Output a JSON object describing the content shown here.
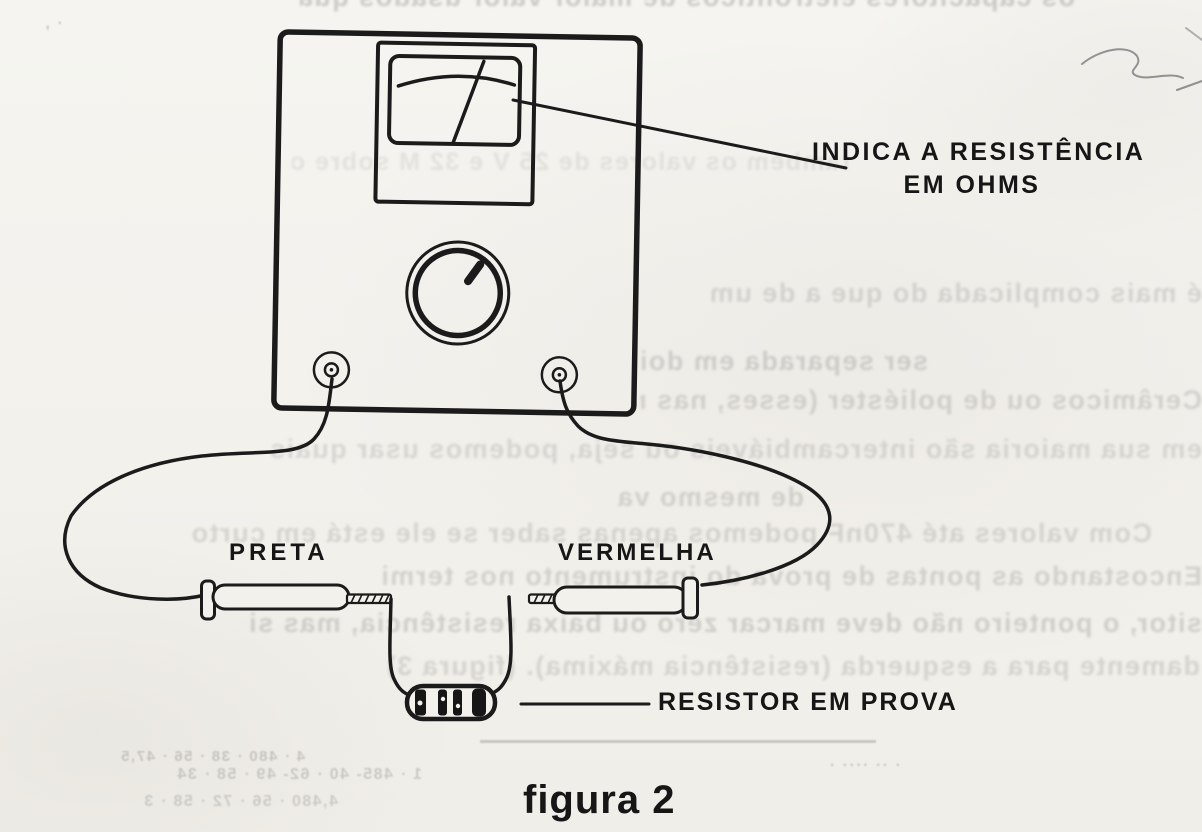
{
  "figure": {
    "caption": "figura 2",
    "annotations": {
      "meter_reading_line1": "INDICA A RESISTÊNCIA",
      "meter_reading_line2": "EM OHMS",
      "black_lead": "PRETA",
      "red_lead": "VERMELHA",
      "resistor_under_test": "RESISTOR EM PROVA"
    },
    "colors": {
      "ink": "#1b1b1b",
      "paper": "#f3f1ec",
      "ghost_text": "#6f6e6c"
    }
  },
  "ghost_text": {
    "lines": [
      "os capacitores eletrolíticos de maior valor usados quando em",
      "· ,",
      "também os valores de 25 V e 32 M sobre o painel do aparelho",
      "é mais complicada do que a de um",
      "ser separada em dois grupos.",
      "Cerâmicos ou de poliéster (esses, nas menores que s",
      "em sua maioria são intercambiáveis ou seja, podemos usar quais",
      "de mesmo valor).",
      "Com valores até 470nF podemos apenas saber se ele está em curto",
      "Encostando as pontas de prova do instrumento nos termi",
      "sitor, o ponteiro não deve marcar zero ou baixa resistência, mas si",
      "damente para a esquerda (resistência máxima).  (figura 3)",
      "4 · 480 · 38 · 56 · 47,5",
      "1 · 485- 40 · 62- 49 · 58 · 34",
      "4,480 · 56 · 72 · 58 · 3",
      "· ·· ···· ·"
    ]
  }
}
